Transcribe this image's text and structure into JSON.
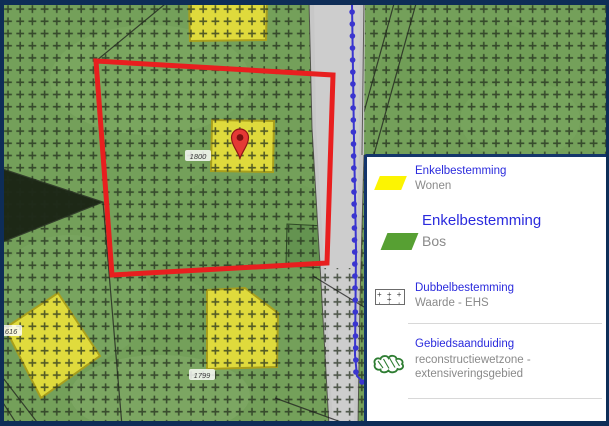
{
  "app": {
    "type": "zoning-plan map viewer"
  },
  "legend": {
    "items": [
      {
        "category": "Enkelbestemming",
        "name": "Wonen"
      },
      {
        "category": "Enkelbestemming",
        "name": "Bos",
        "highlighted": true
      },
      {
        "category": "Dubbelbestemming",
        "name": "Waarde - EHS"
      },
      {
        "category": "Gebiedsaanduiding",
        "name": "reconstructiewetzone - extensiveringsgebied"
      }
    ]
  },
  "map": {
    "parcel_labels": [
      {
        "text": "1800",
        "x": 198,
        "y": 156
      },
      {
        "text": "1616",
        "x": 9,
        "y": 331
      },
      {
        "text": "1799",
        "x": 202,
        "y": 375
      }
    ],
    "marker": {
      "present": true,
      "x": 240,
      "y": 158
    }
  },
  "colors": {
    "legend_heading_blue": "#2b2bdd",
    "legend_label_gray": "#8a8a8a",
    "legend_wonen_yellow": "#fcf402",
    "legend_bos_green": "#57a033",
    "map_zone_yellow": "#e4dd3b",
    "selection_red": "#e81f1f",
    "boundary_blue": "#3a35cf",
    "frame_navy": "#0e2d57",
    "road_gray": "#c7c7c7"
  }
}
